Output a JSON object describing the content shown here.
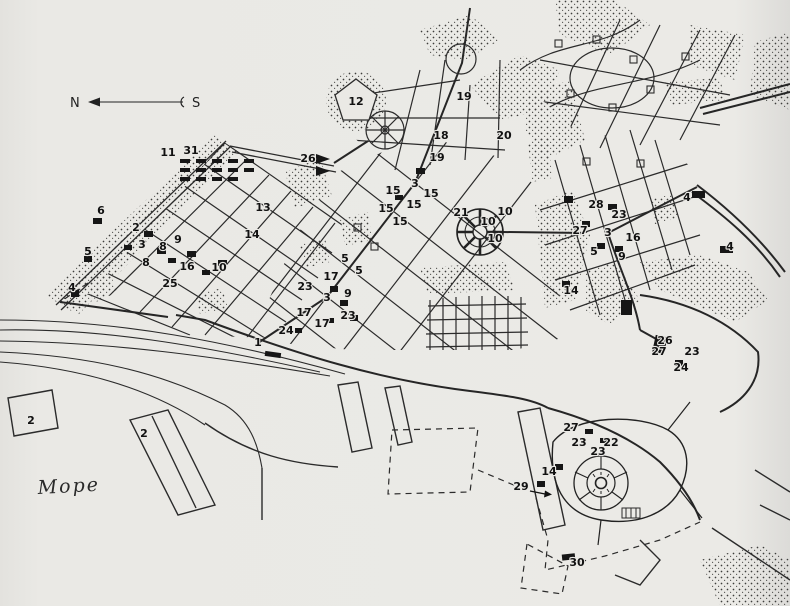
{
  "map": {
    "colors": {
      "paper": "#eae9e5",
      "ink": "#2b2b2b",
      "building": "#161616"
    },
    "compass": {
      "north": "N",
      "south": "S"
    },
    "sea_label": "Море",
    "markers": [
      {
        "label": "11",
        "x": 168,
        "y": 156
      },
      {
        "label": "31",
        "x": 191,
        "y": 154
      },
      {
        "label": "26",
        "x": 308,
        "y": 162
      },
      {
        "label": "12",
        "x": 356,
        "y": 105,
        "s": 13
      },
      {
        "label": "19",
        "x": 464,
        "y": 100,
        "s": 13
      },
      {
        "label": "18",
        "x": 441,
        "y": 139
      },
      {
        "label": "20",
        "x": 504,
        "y": 139,
        "s": 14
      },
      {
        "label": "19",
        "x": 437,
        "y": 161
      },
      {
        "label": "6",
        "x": 101,
        "y": 214,
        "s": 13
      },
      {
        "label": "2",
        "x": 136,
        "y": 231
      },
      {
        "label": "3",
        "x": 142,
        "y": 248,
        "s": 14
      },
      {
        "label": "8",
        "x": 163,
        "y": 250
      },
      {
        "label": "9",
        "x": 178,
        "y": 243
      },
      {
        "label": "5",
        "x": 88,
        "y": 255
      },
      {
        "label": "8",
        "x": 146,
        "y": 266
      },
      {
        "label": "4",
        "x": 72,
        "y": 291
      },
      {
        "label": "16",
        "x": 187,
        "y": 270
      },
      {
        "label": "10",
        "x": 219,
        "y": 271
      },
      {
        "label": "25",
        "x": 170,
        "y": 287
      },
      {
        "label": "13",
        "x": 263,
        "y": 211
      },
      {
        "label": "14",
        "x": 252,
        "y": 238
      },
      {
        "label": "3",
        "x": 415,
        "y": 187,
        "s": 14
      },
      {
        "label": "15",
        "x": 393,
        "y": 194
      },
      {
        "label": "15",
        "x": 431,
        "y": 197
      },
      {
        "label": "15",
        "x": 414,
        "y": 208
      },
      {
        "label": "15",
        "x": 386,
        "y": 212
      },
      {
        "label": "15",
        "x": 400,
        "y": 225
      },
      {
        "label": "21",
        "x": 461,
        "y": 216,
        "s": 12
      },
      {
        "label": "10",
        "x": 505,
        "y": 215
      },
      {
        "label": "10",
        "x": 488,
        "y": 225
      },
      {
        "label": "10",
        "x": 495,
        "y": 242
      },
      {
        "label": "17",
        "x": 331,
        "y": 280
      },
      {
        "label": "5",
        "x": 345,
        "y": 262
      },
      {
        "label": "5",
        "x": 359,
        "y": 274
      },
      {
        "label": "23",
        "x": 305,
        "y": 290,
        "s": 14
      },
      {
        "label": "3",
        "x": 327,
        "y": 301,
        "s": 14
      },
      {
        "label": "9",
        "x": 348,
        "y": 297
      },
      {
        "label": "17",
        "x": 304,
        "y": 316
      },
      {
        "label": "17",
        "x": 322,
        "y": 327
      },
      {
        "label": "23",
        "x": 348,
        "y": 319,
        "s": 13
      },
      {
        "label": "24",
        "x": 286,
        "y": 334
      },
      {
        "label": "1",
        "x": 258,
        "y": 346,
        "s": 12
      },
      {
        "label": "28",
        "x": 596,
        "y": 208
      },
      {
        "label": "23",
        "x": 619,
        "y": 218
      },
      {
        "label": "27",
        "x": 580,
        "y": 234
      },
      {
        "label": "3",
        "x": 608,
        "y": 236,
        "s": 14
      },
      {
        "label": "16",
        "x": 633,
        "y": 241
      },
      {
        "label": "5",
        "x": 594,
        "y": 255
      },
      {
        "label": "9",
        "x": 622,
        "y": 260,
        "s": 13
      },
      {
        "label": "4",
        "x": 687,
        "y": 201
      },
      {
        "label": "4",
        "x": 730,
        "y": 250
      },
      {
        "label": "14",
        "x": 571,
        "y": 294
      },
      {
        "label": "26",
        "x": 665,
        "y": 344
      },
      {
        "label": "27",
        "x": 659,
        "y": 355
      },
      {
        "label": "23",
        "x": 692,
        "y": 355
      },
      {
        "label": "24",
        "x": 681,
        "y": 371
      },
      {
        "label": "27",
        "x": 571,
        "y": 431
      },
      {
        "label": "23",
        "x": 579,
        "y": 446
      },
      {
        "label": "22",
        "x": 611,
        "y": 446
      },
      {
        "label": "23",
        "x": 598,
        "y": 455
      },
      {
        "label": "14",
        "x": 549,
        "y": 475
      },
      {
        "label": "29",
        "x": 521,
        "y": 490,
        "s": 13
      },
      {
        "label": "30",
        "x": 577,
        "y": 566,
        "s": 13
      },
      {
        "label": "2",
        "x": 31,
        "y": 424,
        "s": 13
      },
      {
        "label": "2",
        "x": 144,
        "y": 437,
        "s": 13
      }
    ]
  }
}
